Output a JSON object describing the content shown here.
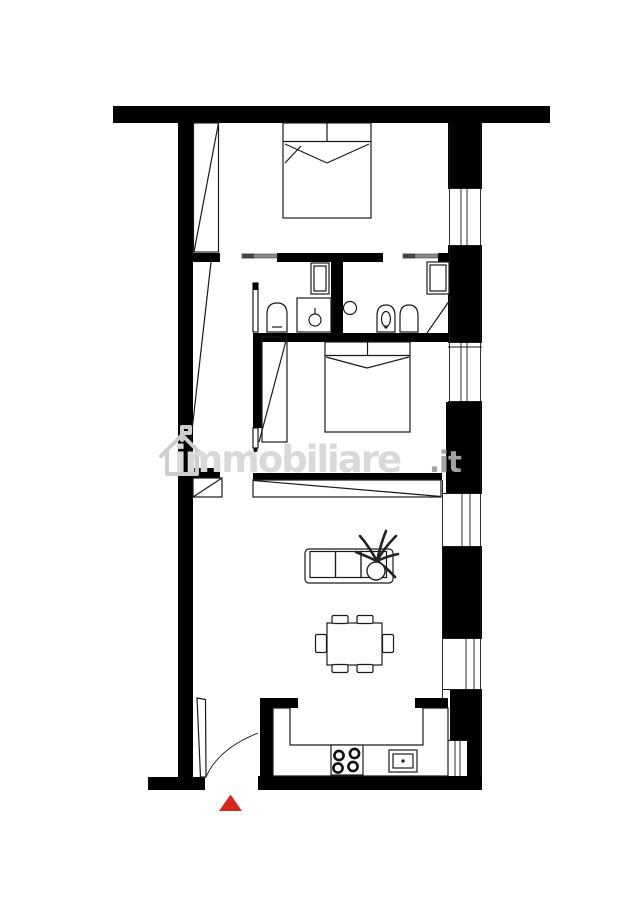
{
  "canvas": {
    "width": 635,
    "height": 900,
    "background": "#ffffff"
  },
  "colors": {
    "canvas_bg": "#ffffff",
    "wall": "#000000",
    "line": "#1a1a1a",
    "slider": "#8a8a8a",
    "entrance_marker": "#d9261d",
    "wm_brand": "#d9d9d9",
    "wm_tld": "#a3a3a3",
    "wm_icon": "#cdcdcd"
  },
  "watermark": {
    "brand": "immobiliare",
    "tld": ".it",
    "icon": "house-logo-icon"
  },
  "plan_type": "apartment-floor-plan",
  "symbols": [
    {
      "name": "double-bed",
      "room": "bedroom-top"
    },
    {
      "name": "wardrobe-diagonal",
      "room": "bedroom-top"
    },
    {
      "name": "sliding-door",
      "room": "bathroom-left"
    },
    {
      "name": "washing-machine",
      "room": "bathroom-left"
    },
    {
      "name": "toilet",
      "room": "bathroom-left"
    },
    {
      "name": "vanity-sink",
      "room": "bathroom-left"
    },
    {
      "name": "hinged-door-leaf",
      "room": "bathroom-left"
    },
    {
      "name": "sliding-door",
      "room": "bathroom-right"
    },
    {
      "name": "wall-mounted-sink",
      "room": "bathroom-right"
    },
    {
      "name": "bidet",
      "room": "bathroom-right"
    },
    {
      "name": "toilet",
      "room": "bathroom-right"
    },
    {
      "name": "shower-box",
      "room": "bathroom-right"
    },
    {
      "name": "double-bed",
      "room": "bedroom-middle"
    },
    {
      "name": "wardrobe-diagonal",
      "room": "bedroom-middle"
    },
    {
      "name": "hinged-door-leaf",
      "room": "bedroom-middle"
    },
    {
      "name": "built-in-closet",
      "room": "living-room"
    },
    {
      "name": "sofa-with-plant",
      "room": "living-room"
    },
    {
      "name": "dining-table-six-chairs",
      "room": "living-room"
    },
    {
      "name": "u-shaped-counter",
      "room": "kitchen"
    },
    {
      "name": "cooktop-four-burners",
      "room": "kitchen"
    },
    {
      "name": "kitchen-sink",
      "room": "kitchen"
    },
    {
      "name": "entrance-door-with-swing",
      "room": "entrance"
    },
    {
      "name": "entrance-marker-triangle",
      "room": "entrance"
    },
    {
      "name": "window",
      "room": "right-facade",
      "count": 5
    }
  ]
}
